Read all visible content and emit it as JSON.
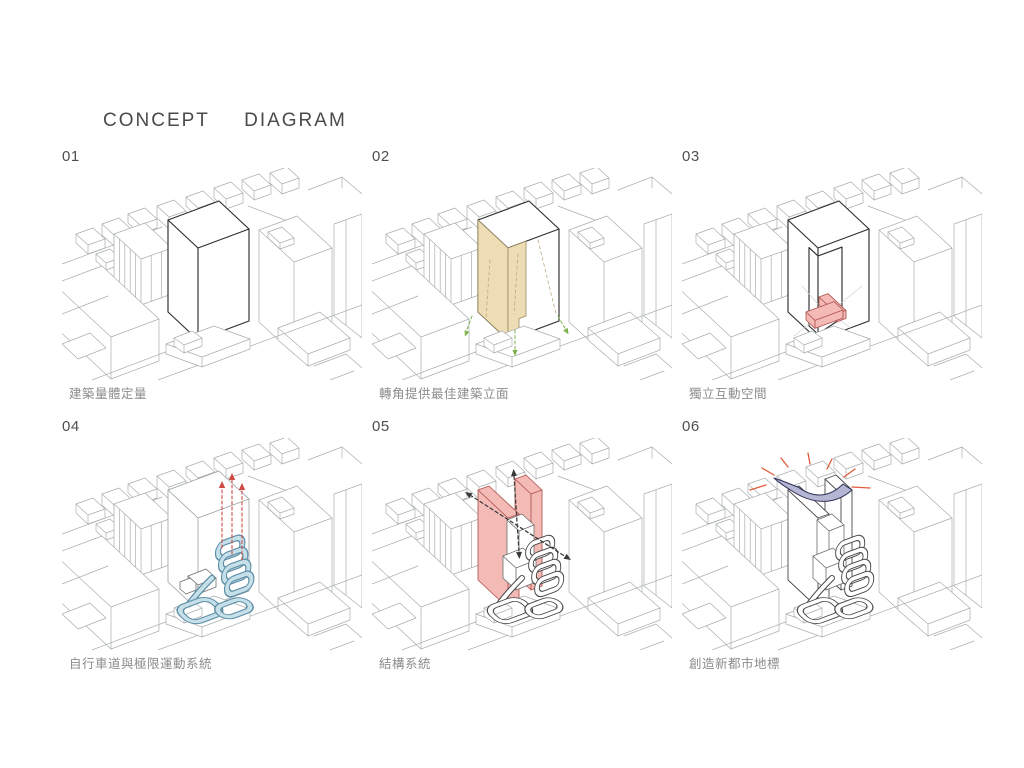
{
  "title": "CONCEPT  DIAGRAM",
  "panels": [
    {
      "number": "01",
      "caption": "建築量體定量"
    },
    {
      "number": "02",
      "caption": "轉角提供最佳建築立面"
    },
    {
      "number": "03",
      "caption": "獨立互動空間"
    },
    {
      "number": "04",
      "caption": "自行車道與極限運動系統"
    },
    {
      "number": "05",
      "caption": "結構系統"
    },
    {
      "number": "06",
      "caption": "創造新都市地標"
    }
  ],
  "colors": {
    "context_line": "#a9aeb1",
    "tower_line": "#2e2e2e",
    "tan_fill": "#eedcb5",
    "tan_edge": "#9c8a5f",
    "green_arrow": "#7fb24e",
    "red_fill": "#f3bab6",
    "red_edge": "#b0524d",
    "red_dash": "#cf4a45",
    "blue_fill": "#c6e0ea",
    "blue_edge": "#5e8fa6",
    "dark_dash": "#3a3a3a",
    "purple_fill": "#b5b5d4",
    "purple_edge": "#2f2f55",
    "orange_ray": "#e05a3a",
    "title_color": "#4a4a4a",
    "number_color": "#4f4f4f",
    "caption_color": "#8c8c8c"
  }
}
